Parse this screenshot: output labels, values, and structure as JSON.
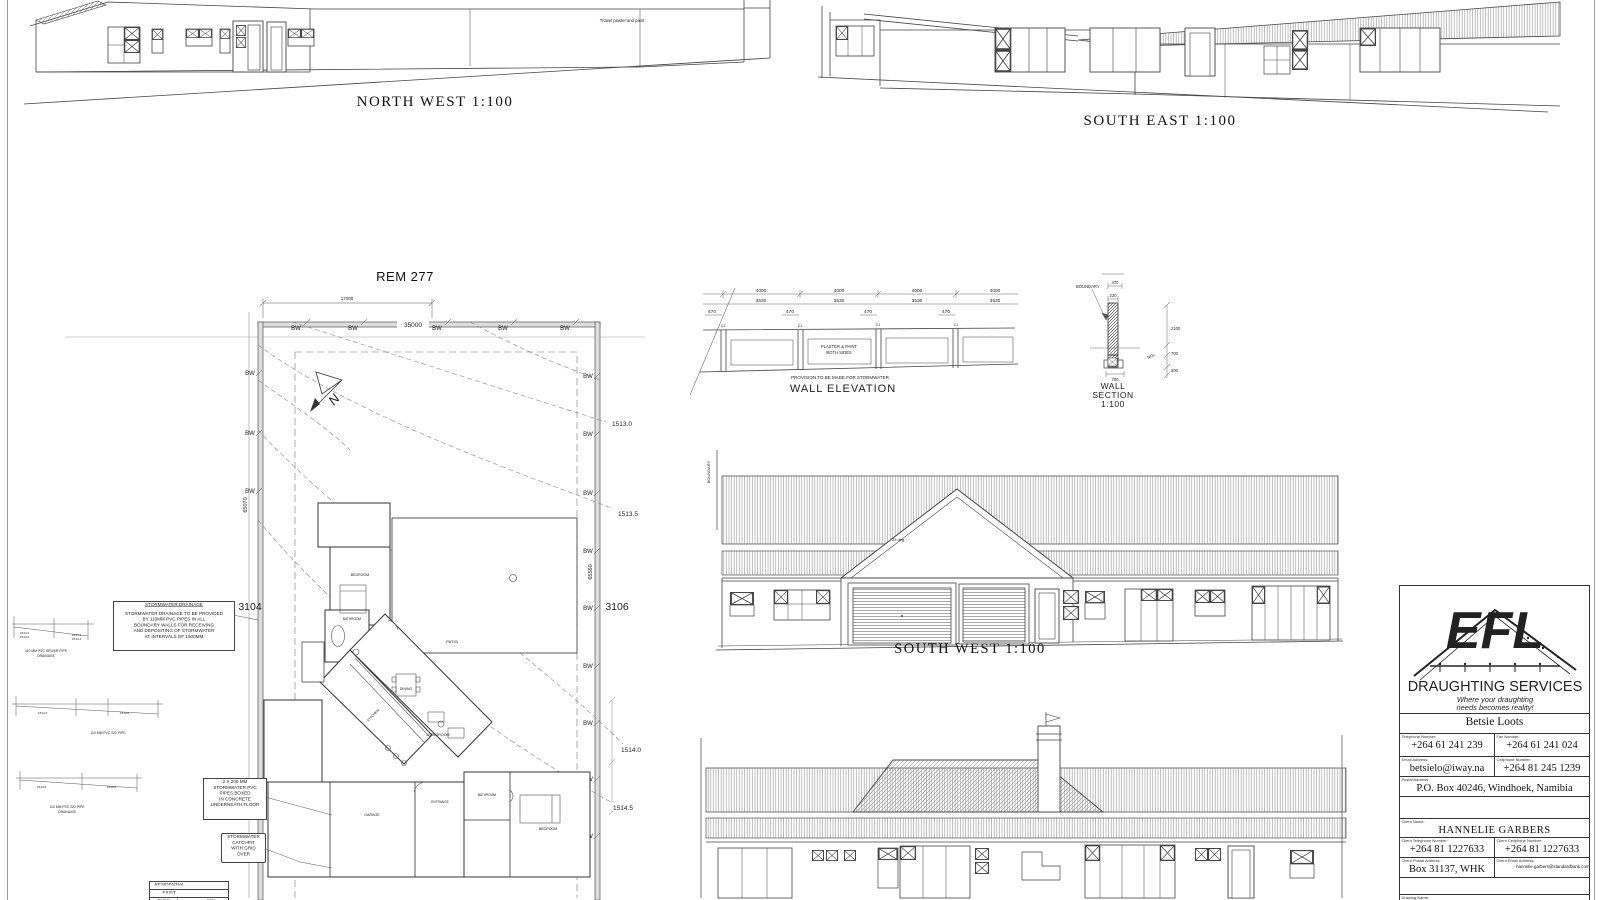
{
  "titles": {
    "north_west": "NORTH WEST 1:100",
    "south_east": "SOUTH EAST 1:100",
    "south_west": "SOUTH  WEST 1:100",
    "site_plan": "REM 277",
    "wall_elevation": "WALL ELEVATION",
    "wall_section": [
      "WALL",
      "SECTION",
      "1:100"
    ]
  },
  "nw_elevation": {
    "note": "Trowel plaster and paint"
  },
  "sw_elevation": {
    "boundary": "BOUNDARY",
    "roof_pitch": "25 deg"
  },
  "site_plan": {
    "erf_left": "3104",
    "erf_right": "3106",
    "north": "N",
    "bw": "BW",
    "dim_top": "35000",
    "dim_top_left": "17000",
    "dim_left": "65070",
    "dim_right": "65560",
    "contours": [
      "1513.0",
      "1513.5",
      "1514.0",
      "1514.5"
    ],
    "rooms": [
      "BEDROOM",
      "BATHROOM",
      "DINING",
      "PATIO",
      "KITCHEN",
      "LIVINGROOM",
      "GARAGE",
      "ENTRANCE",
      "BATHROOM",
      "BEDROOM"
    ]
  },
  "wall_elevation": {
    "dim_a": "4000",
    "dim_b": "3530",
    "dim_c": "470",
    "column": "C1",
    "panel_note": [
      "PLASTER & PAINT",
      "BOTH SIDES"
    ],
    "note": "PROVISION TO BE MADE FOR STORMWATER"
  },
  "wall_section": {
    "boundary": "BOUNDARY",
    "dim_top": "470",
    "dim_width": "220",
    "dim_footing": "700",
    "dim_height": "2100",
    "dim_below": "700",
    "dim_base": "200",
    "ngl": "NGL"
  },
  "notes": {
    "stormwater": {
      "heading": "STORMWATER DRAINAGE",
      "body": [
        "STORMWATER DRAINAGE TO BE PROVIDED",
        "BY 110MM PVC PIPES IN ALL",
        "BOUNDARY WALLS FOR RECEIVING",
        "AND DEPOSITING OF STORMWATER",
        "AT INTERVALS OF 1500MM"
      ]
    },
    "pipes": [
      "2 X 200 MM",
      "STORMWATER PVC",
      "PIPES BOXED",
      "IN CONCRETE",
      "UNDERNEATH FLOOR"
    ],
    "catchpit": [
      "STORMWATER",
      "CATCHPIT",
      "WITH GRID",
      "OVER"
    ],
    "profile1": {
      "levels": [
        "1514.2",
        "1514.5",
        "1514.1",
        "1514.4"
      ],
      "caption": [
        "110 MM PVC SEWER PIPE",
        "DRAINAGE"
      ]
    },
    "profile2": {
      "levels": [
        "1514.3",
        "1514.6"
      ],
      "caption": "110 MM PVC S/D PIPE"
    },
    "profile3": {
      "levels": [
        "1514.6",
        "1515.0"
      ],
      "caption": [
        "110 MM PVC S/D PIPE",
        "DRAINAGE"
      ]
    }
  },
  "schedule": {
    "rows": [
      "RESIDENTIAL DWELLING",
      "EXIST. STRUCTURE",
      "BLDG REGION"
    ],
    "value": "50%"
  },
  "title_block": {
    "logo_text": "EFL",
    "company": "DRAUGHTING SERVICES",
    "tagline": [
      "Where your draughting",
      "needs becomes reality!"
    ],
    "contact_name": "Betsie Loots",
    "labels": {
      "telephone": "Telephone Number:",
      "fax": "Fax Number:",
      "email": "Email Address:",
      "cellphone": "Cellphone Number:",
      "postal": "Postal Address:",
      "client_name": "Client Name:",
      "client_telephone": "Client Telephone Number:",
      "client_cellphone": "Client Cellphone Number:",
      "client_postal": "Client Postal Address:",
      "client_email": "Client Email Address:",
      "drawing_name": "Drawing Name:"
    },
    "telephone": "+264 61 241 239",
    "fax": "+264 61 241 024",
    "email": "betsielo@iway.na",
    "cellphone": "+264 81 245 1239",
    "postal": "P.O. Box 40246, Windhoek, Namibia",
    "client_name": "HANNELIE GARBERS",
    "client_telephone": "+264 81 1227633",
    "client_cellphone": "+264 81 1227633",
    "client_postal": "Box 31137, WHK",
    "client_email": "hannelie.garbers@standardbank.com.na",
    "drawing_name": "Proposed New Dwelling"
  }
}
